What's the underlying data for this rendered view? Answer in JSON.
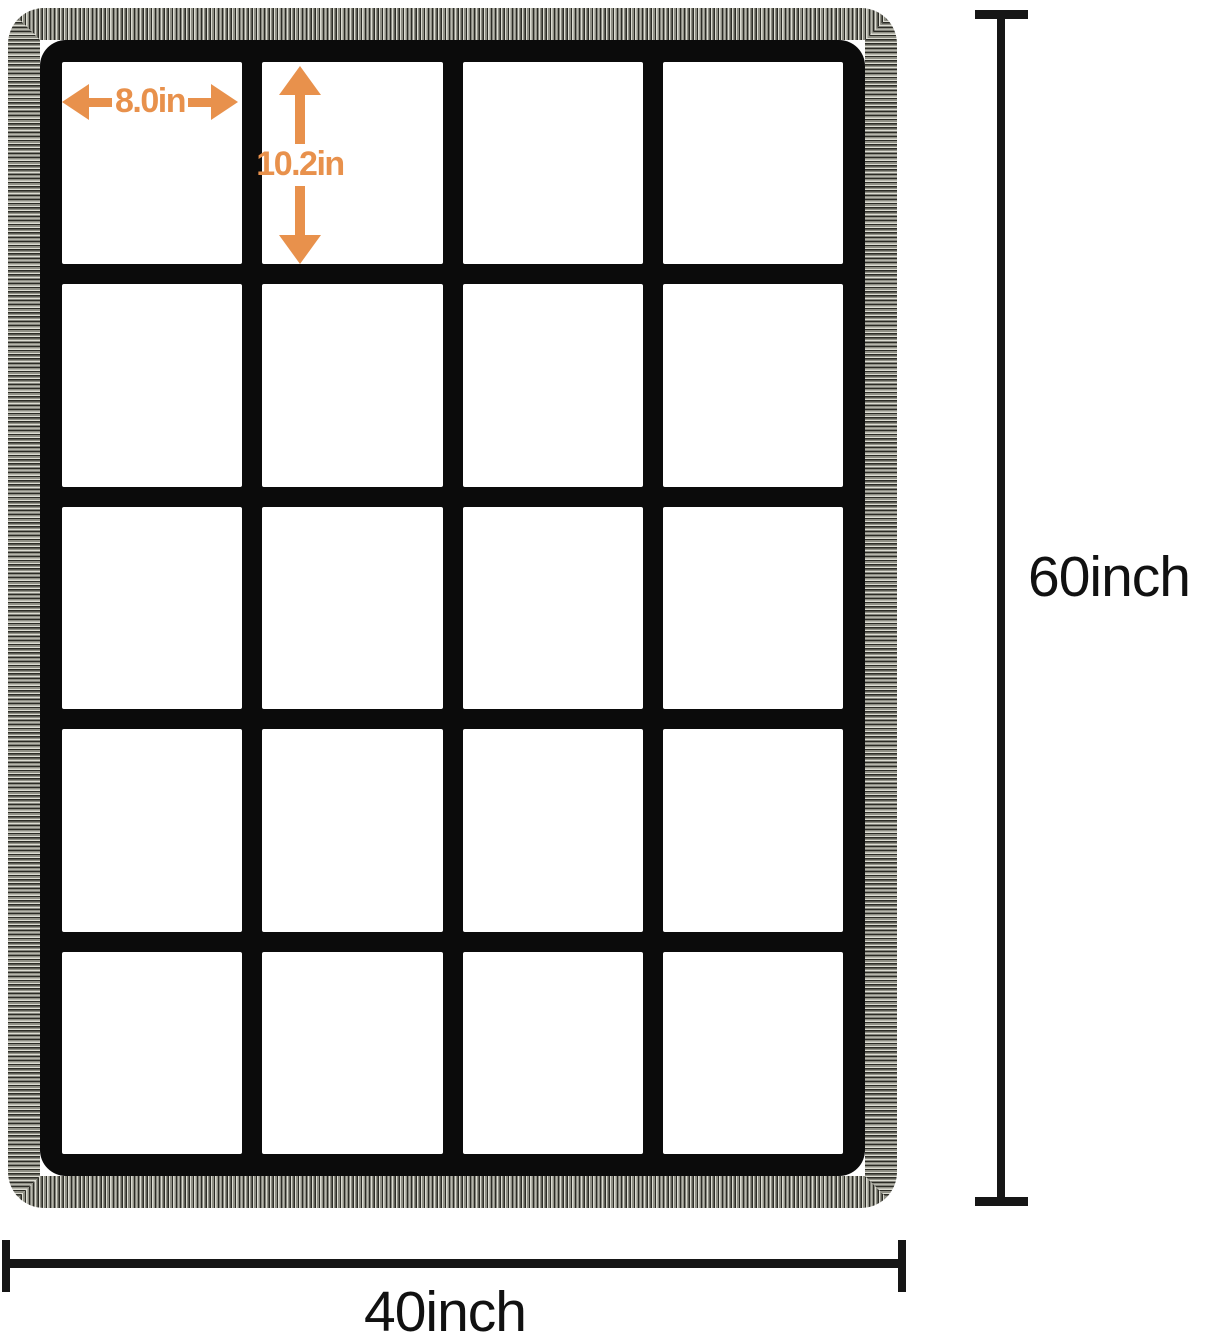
{
  "diagram": {
    "description": "grid photo blanket dimension diagram",
    "grid": {
      "rows": 5,
      "columns": 4,
      "cell_count": 20
    },
    "cell_measure": {
      "width_label": "8.0in",
      "height_label": "10.2in"
    },
    "overall_measure": {
      "height_label": "60inch",
      "width_label": "40inch"
    },
    "colors": {
      "accent_orange": "#E8914C",
      "grid_black": "#0b0b0b",
      "ruler_black": "#161616",
      "binding_gray": "#8f8f85",
      "background": "#ffffff"
    }
  }
}
